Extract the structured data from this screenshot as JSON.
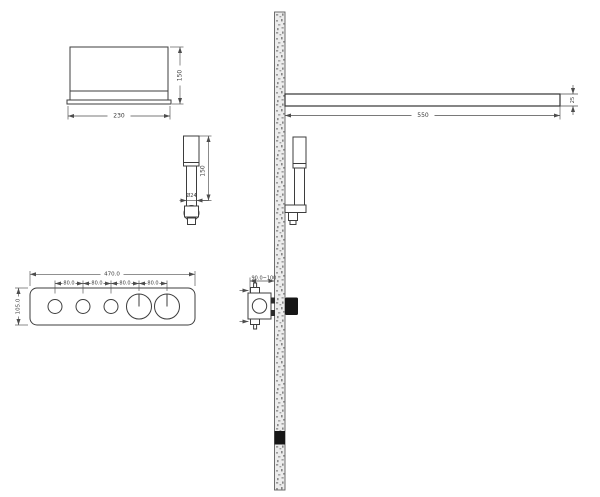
{
  "views": {
    "showerhead_front": {
      "width_label": "230",
      "height_label": "150"
    },
    "handshower_detail": {
      "length_label": "150",
      "diameter_label": "Ø24"
    },
    "shower_arm": {
      "length_label": "550",
      "thickness_label": "25"
    },
    "control_panel_front": {
      "width_label": "470.0",
      "height_label": "105.0",
      "spacing_labels": [
        "80.0",
        "80.0",
        "80.0",
        "80.0"
      ]
    },
    "valve_side": {
      "depth_label": "90.0~100"
    }
  },
  "colors": {
    "background": "#ffffff",
    "object_line": "#3d3d3d",
    "dimension_line": "#4d4d4d",
    "wall_fill": "#ececec",
    "wall_speckle": "#8f8f8f",
    "wall_dark_band": "#111111",
    "knob_fill": "#161616"
  }
}
